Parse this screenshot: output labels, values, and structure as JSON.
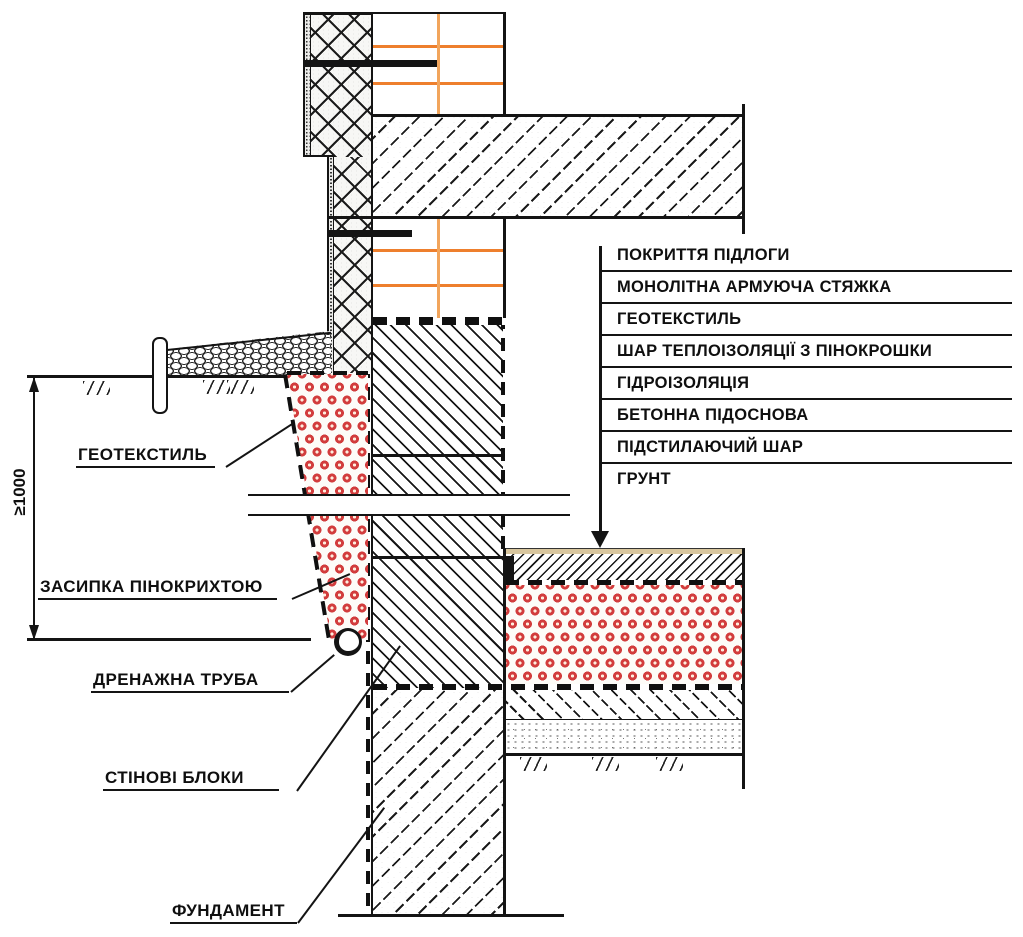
{
  "diagram": {
    "kind": "foundation-insulation-section-detail",
    "dimension_label": "≥1000",
    "callouts_left": [
      {
        "label": "ГЕОТЕКСТИЛЬ"
      },
      {
        "label": "ЗАСИПКА ПІНОКРИХТОЮ"
      },
      {
        "label": "ДРЕНАЖНА ТРУБА"
      },
      {
        "label": "СТІНОВІ БЛОКИ"
      },
      {
        "label": "ФУНДАМЕНТ"
      }
    ],
    "floor_layers_list": [
      "ПОКРИТТЯ ПІДЛОГИ",
      "МОНОЛІТНА АРМУЮЧА СТЯЖКА",
      "ГЕОТЕКСТИЛЬ",
      "ШАР ТЕПЛОІЗОЛЯЦІЇ З ПІНОКРОШКИ",
      "ГІДРОІЗОЛЯЦІЯ",
      "БЕТОННА ПІДОСНОВА",
      "ПІДСТИЛАЮЧИЙ ШАР",
      "ГРУНТ"
    ]
  },
  "colors": {
    "line": "#141414",
    "brick-joint": "#ee7f2d",
    "brick-joint-light": "#f2a55c",
    "foam-ring": "#d23d3d",
    "floor-covering": "#d8c69e"
  }
}
